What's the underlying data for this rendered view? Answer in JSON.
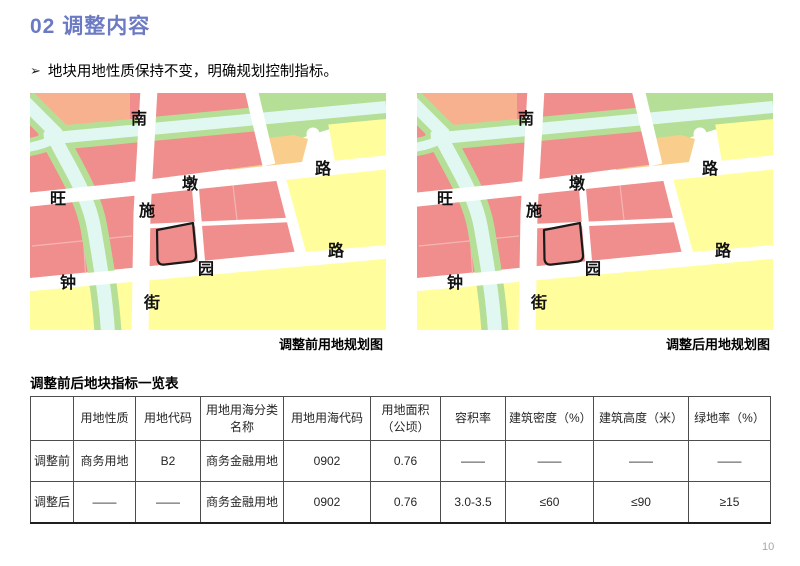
{
  "header": {
    "title": "02 调整内容"
  },
  "bullet": {
    "marker": "➢",
    "text": "地块用地性质保持不变，明确规划控制指标。"
  },
  "maps": [
    {
      "caption": "调整前用地规划图"
    },
    {
      "caption": "调整后用地规划图"
    }
  ],
  "map_labels": {
    "vertical_street": [
      "南",
      "施",
      "街"
    ],
    "upper_road": [
      "旺",
      "墩",
      "路"
    ],
    "lower_road": [
      "钟",
      "园",
      "路"
    ]
  },
  "table": {
    "title": "调整前后地块指标一览表",
    "headers": [
      "",
      "用地性质",
      "用地代码",
      "用地用海分类名称",
      "用地用海代码",
      "用地面积（公顷）",
      "容积率",
      "建筑密度（%）",
      "建筑高度（米）",
      "绿地率（%）"
    ],
    "rows": [
      {
        "label": "调整前",
        "cells": [
          "商务用地",
          "B2",
          "商务金融用地",
          "0902",
          "0.76",
          "——",
          "——",
          "——",
          "——"
        ]
      },
      {
        "label": "调整后",
        "cells": [
          "——",
          "——",
          "商务金融用地",
          "0902",
          "0.76",
          "3.0-3.5",
          "≤60",
          "≤90",
          "≥15"
        ]
      }
    ]
  },
  "footer": {
    "page_number": "10"
  },
  "colors": {
    "accent_title": "#6C7AC4",
    "map_pink": "#EF8E8C",
    "map_salmon": "#F8B18F",
    "map_green": "#B5DF96",
    "map_water": "#E1F8F2",
    "map_yellow": "#FFFD9C",
    "map_orange": "#F9CE8D",
    "parcel_outline": "#1A1A1A",
    "table_border": "#4D4D4D",
    "page_number_gray": "#A6A6A6"
  }
}
